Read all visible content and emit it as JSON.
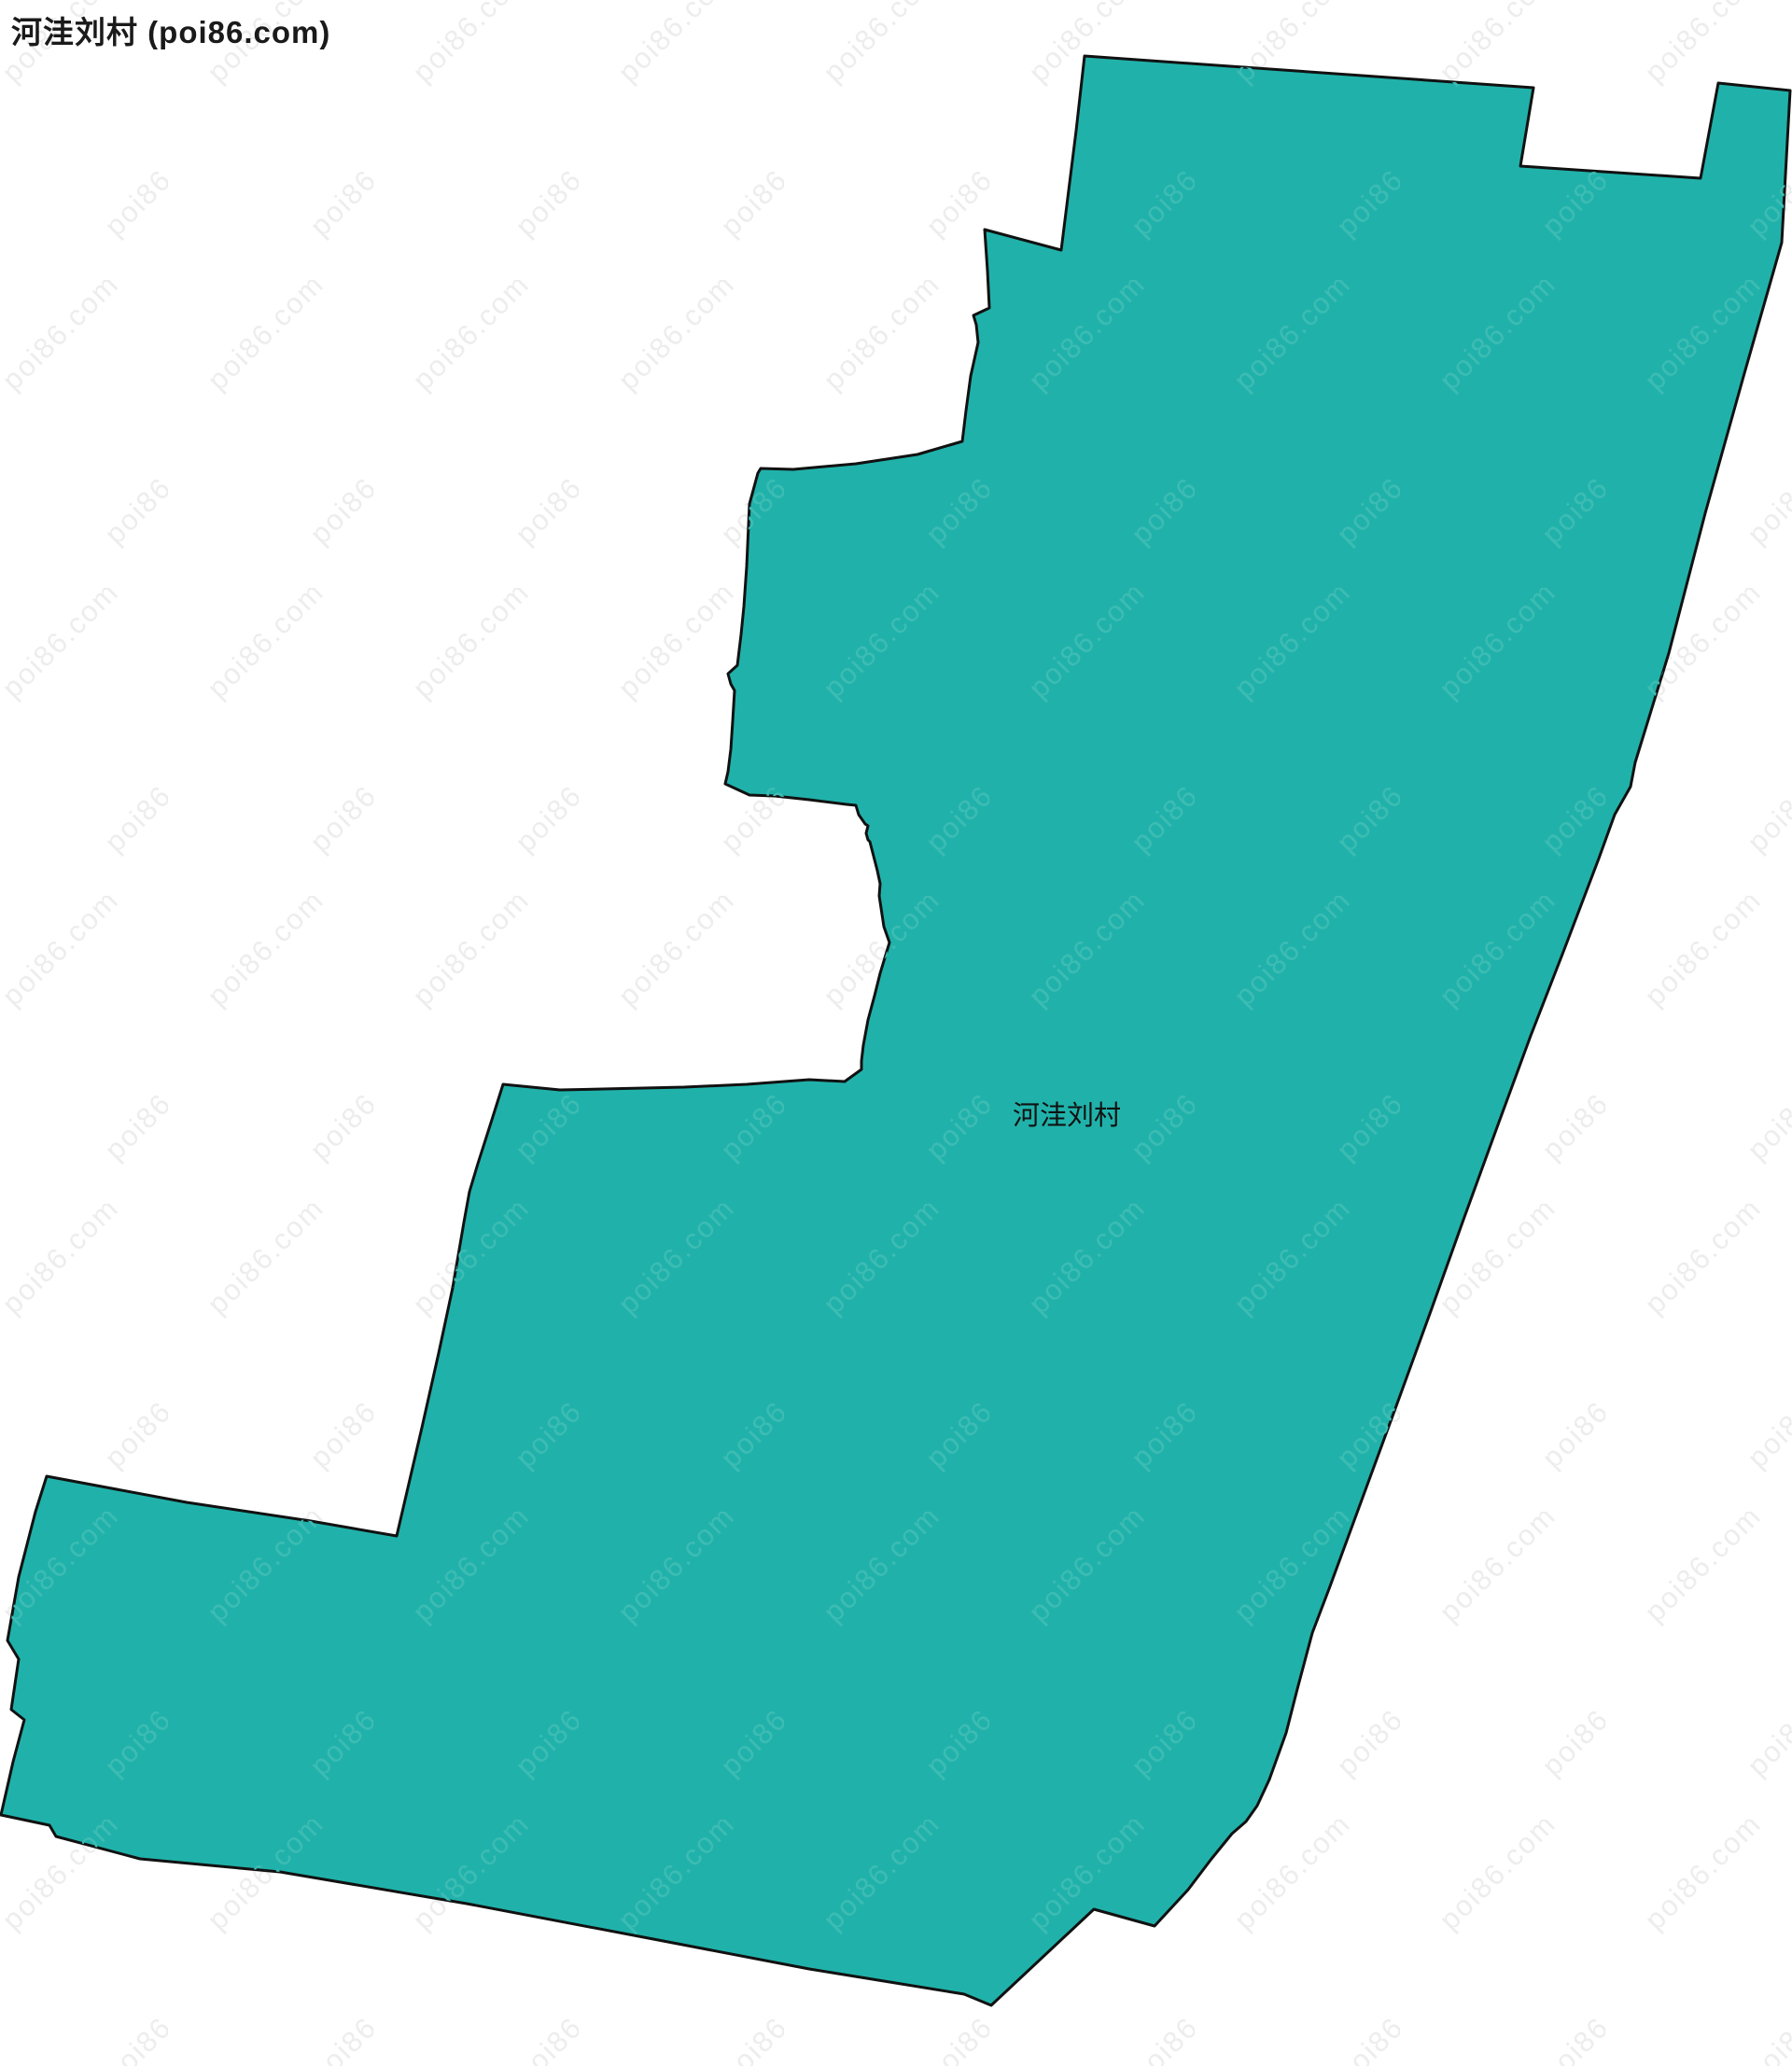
{
  "page": {
    "title": "河洼刘村 (poi86.com)"
  },
  "map": {
    "label": "河洼刘村",
    "watermark_text": "poi86.com",
    "colors": {
      "background": "#ffffff",
      "region_fill": "#20b2aa",
      "region_border": "#111111",
      "watermark_on_white": "#ededed",
      "watermark_on_region": "#3dbcb4",
      "label_color": "#111111",
      "title_color": "#1a1a1a"
    }
  }
}
